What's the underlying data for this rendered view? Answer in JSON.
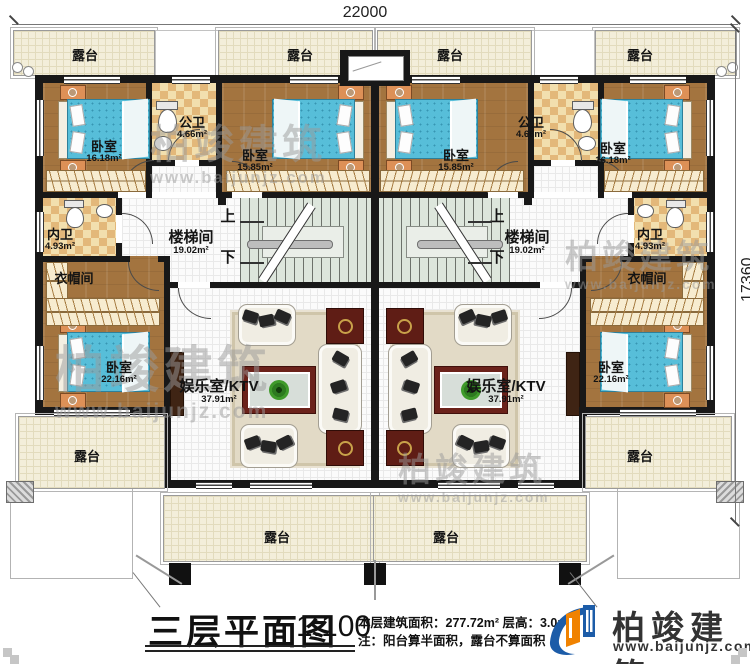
{
  "dimensions": {
    "width": "22000",
    "height": "17360"
  },
  "labels": {
    "terrace": "露台",
    "bedroom": "卧室",
    "public_bath": "公卫",
    "private_bath": "内卫",
    "cloakroom": "衣帽间",
    "stairwell": "楼梯间",
    "ktv": "娱乐室/KTV",
    "up": "上",
    "down": "下"
  },
  "areas": {
    "bedroom_a": "16.18m²",
    "bedroom_b": "15.85m²",
    "bedroom_c": "22.16m²",
    "public_bath": "4.66m²",
    "private_bath": "4.93m²",
    "stairwell": "19.02m²",
    "ktv": "37.91m²"
  },
  "titleblock": {
    "title": "三层平面图",
    "scale": "1:100",
    "area_line": "本层建筑面积：277.72m²  层高：3.0m",
    "note_line": "注：阳台算半面积，露台不算面积"
  },
  "brand": {
    "name": "柏竣建筑",
    "url": "www.baijunjz.com"
  }
}
